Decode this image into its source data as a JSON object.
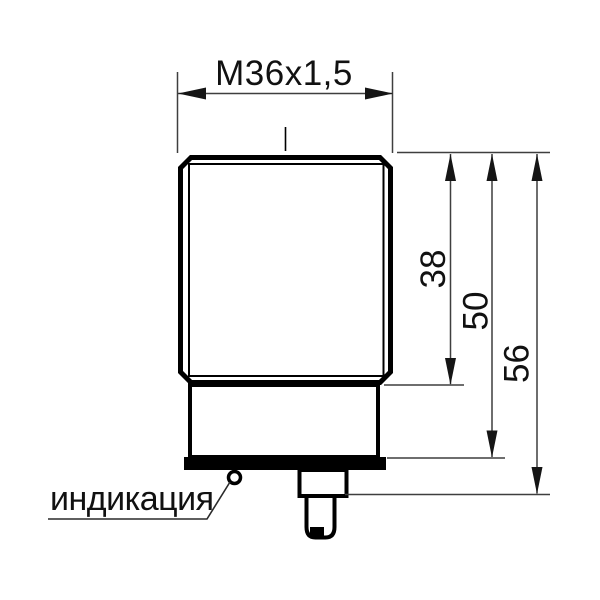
{
  "drawing": {
    "type": "technical-dimension-drawing",
    "subject": "cylindrical threaded sensor, side view",
    "background_color": "#ffffff",
    "line_color": "#000000",
    "dimension_line_color": "#3f3f3f",
    "text_color": "#111111",
    "thread_dimension": {
      "label": "M36x1,5"
    },
    "vertical_dimensions": [
      {
        "label": "38"
      },
      {
        "label": "50"
      },
      {
        "label": "56"
      }
    ],
    "callout": {
      "label": "индикация",
      "target": "led-indicator"
    }
  }
}
